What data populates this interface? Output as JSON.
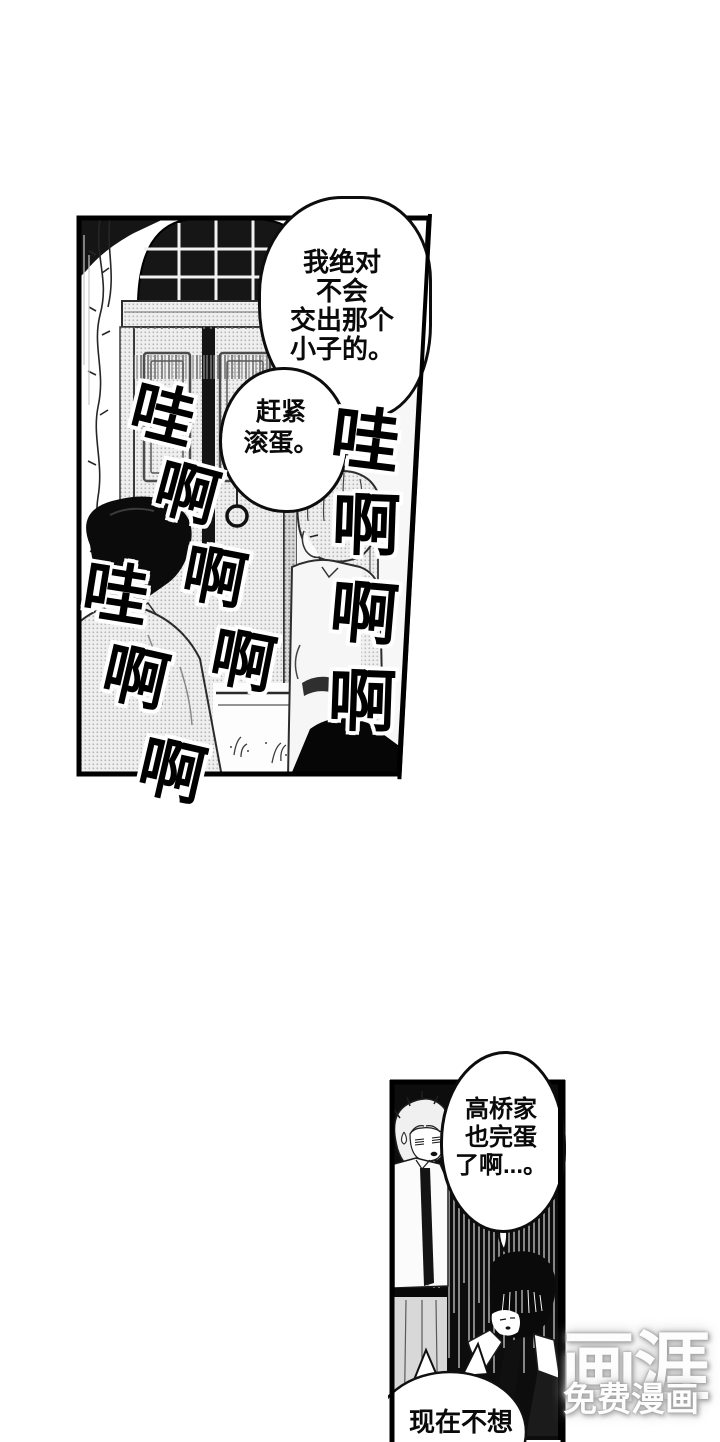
{
  "colors": {
    "ink": "#000000",
    "paper": "#ffffff",
    "panel_black": "#0d0d0d",
    "halftone_gray": "#bdbdbd",
    "watermark_gray": "#b7b7b7"
  },
  "top_panel": {
    "bubble_refuse": {
      "lines": [
        "我绝对",
        "不会",
        "交出那个",
        "小子的。"
      ]
    },
    "bubble_scram": {
      "lines": [
        "赶紧",
        "滚蛋。"
      ]
    },
    "sfx": {
      "middle": [
        "哇",
        "啊",
        "啊",
        "啊"
      ],
      "left": [
        "哇",
        "啊",
        "啊"
      ],
      "right": [
        "哇",
        "啊",
        "啊",
        "啊"
      ]
    }
  },
  "bottom_panel": {
    "bubble_takahashi": {
      "lines": [
        "高桥家",
        "也完蛋",
        "了啊...。"
      ]
    },
    "bubble_now": {
      "lines": [
        "现在不想"
      ]
    }
  },
  "watermark": {
    "logo": "画涯",
    "tagline": "免费漫画"
  }
}
